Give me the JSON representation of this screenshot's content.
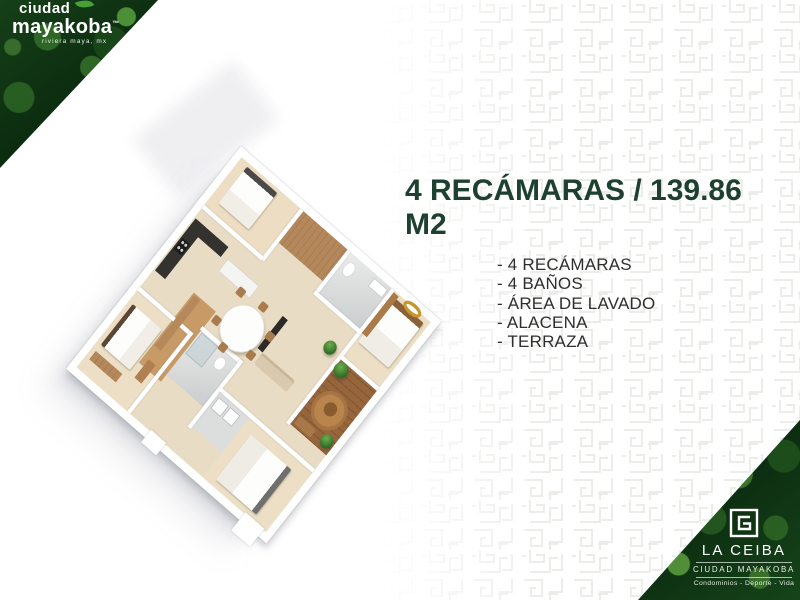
{
  "brand_top_left": {
    "line1": "ciudad",
    "line2": "mayakoba",
    "trademark": "™",
    "subtitle": "riviera maya, mx"
  },
  "main": {
    "title": "4 RECÁMARAS / 139.86 M2",
    "features": [
      "- 4 RECÁMARAS",
      "- 4 BAÑOS",
      "- ÁREA DE LAVADO",
      "- ALACENA",
      "- TERRAZA"
    ]
  },
  "floor_plan": {
    "label": "3D isometric floor plan of 4-bedroom unit"
  },
  "brand_bottom_right": {
    "name": "LA CEIBA",
    "sub_brand": "CIUDAD MAYAKOBA",
    "tagline": "Condominios - Deporte - Vida"
  },
  "icons": {
    "leaf": "leaf-icon",
    "emblem": "la-ceiba-emblem-icon"
  },
  "colors": {
    "title_green": "#1d4030",
    "body_text": "#2e2e2e",
    "leaf_green": "#46a037",
    "foliage_dark": "#0c2a10",
    "floor_beige": "#e9dcc4",
    "wood_brown": "#b5885c",
    "deck_brown": "#96653c",
    "gold_accent": "#c6952f",
    "pattern_line": "#e8ebe6"
  }
}
